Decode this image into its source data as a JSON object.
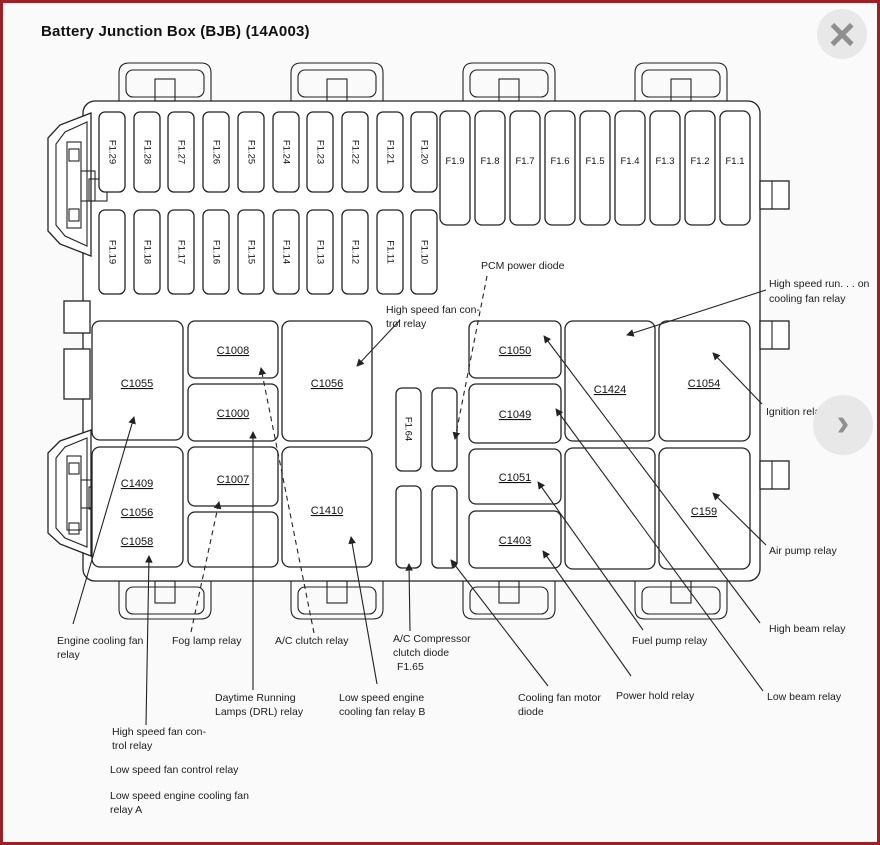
{
  "window": {
    "title": "Battery Junction Box (BJB) (14A003)",
    "close_icon": "×",
    "next_icon": "›"
  },
  "colors": {
    "frame_border": "#9c2125",
    "canvas_background": "#fafafa",
    "diagram_line": "#222222",
    "control_background": "#e8e8e8",
    "control_glyph": "#8f8f8f"
  },
  "diagram": {
    "fuses_top_left": [
      "F1.29",
      "F1.28",
      "F1.27",
      "F1.26",
      "F1.25",
      "F1.24",
      "F1.23",
      "F1.22",
      "F1.21",
      "F1.20"
    ],
    "fuses_top_right": [
      "F1.9",
      "F1.8",
      "F1.7",
      "F1.6",
      "F1.5",
      "F1.4",
      "F1.3",
      "F1.2",
      "F1.1"
    ],
    "fuses_second_row": [
      "F1.19",
      "F1.18",
      "F1.17",
      "F1.16",
      "F1.15",
      "F1.14",
      "F1.13",
      "F1.12",
      "F1.11",
      "F1.10"
    ],
    "fuse_f164": "F1.64",
    "connectors": {
      "c1055": "C1055",
      "c1008": "C1008",
      "c1000": "C1000",
      "c1056_top": "C1056",
      "c1409": "C1409",
      "c1056_left": "C1056",
      "c1058": "C1058",
      "c1007": "C1007",
      "c1410": "C1410",
      "c1050": "C1050",
      "c1049": "C1049",
      "c1051": "C1051",
      "c1403": "C1403",
      "c1424": "C1424",
      "c1054": "C1054",
      "c159": "C159"
    },
    "labels": {
      "pcm_power_diode": "PCM power diode",
      "high_speed_fan_control_upper_line1": "High speed fan con-",
      "high_speed_fan_control_upper_line2": "trol relay",
      "high_speed_run_line1": "High speed run. . . on",
      "high_speed_run_line2": "cooling fan relay",
      "ignition_relay": "Ignition relay",
      "air_pump_relay": "Air pump relay",
      "high_beam_relay": "High beam relay",
      "low_beam_relay": "Low beam relay",
      "fuel_pump_relay": "Fuel pump relay",
      "power_hold_relay": "Power hold relay",
      "cooling_fan_motor_line1": "Cooling fan motor",
      "cooling_fan_motor_line2": "diode",
      "ac_compressor_line1": "A/C Compressor",
      "ac_compressor_line2": "clutch diode",
      "ac_compressor_line3": "F1.65",
      "low_speed_b_line1": "Low speed engine",
      "low_speed_b_line2": "cooling fan relay B",
      "drl_line1": "Daytime Running",
      "drl_line2": "Lamps (DRL) relay",
      "ac_clutch_relay": "A/C clutch relay",
      "fog_lamp_relay": "Fog lamp relay",
      "engine_cooling_line1": "Engine cooling fan",
      "engine_cooling_line2": "relay",
      "high_speed_fan_control_lower_line1": "High speed fan con-",
      "high_speed_fan_control_lower_line2": "trol relay",
      "low_speed_fan_control": "Low speed fan control relay",
      "low_speed_a_line1": "Low speed engine cooling fan",
      "low_speed_a_line2": "relay A"
    }
  }
}
